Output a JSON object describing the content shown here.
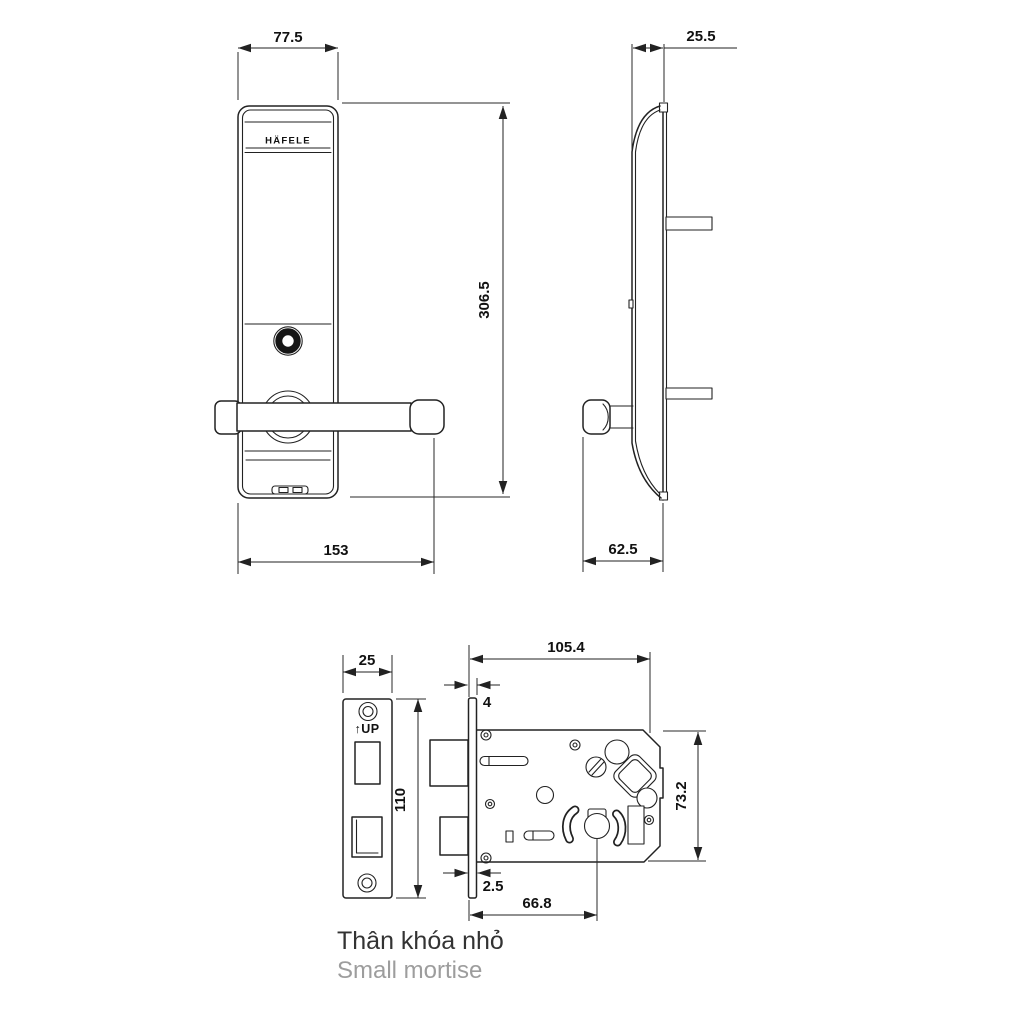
{
  "drawing": {
    "brand": "HÄFELE",
    "front_view": {
      "dim_width": "77.5",
      "dim_height": "306.5",
      "dim_total_width": "153"
    },
    "side_view": {
      "dim_depth": "25.5",
      "dim_handle_depth": "62.5"
    },
    "faceplate_view": {
      "up_label": "↑UP",
      "dim_width": "25",
      "dim_height": "110"
    },
    "mortise_body_view": {
      "dim_width": "105.4",
      "dim_height": "73.2",
      "dim_faceplate_thickness": "4",
      "dim_edge_offset": "2.5",
      "dim_backset": "66.8"
    },
    "caption": {
      "primary": "Thân khóa nhỏ",
      "secondary": "Small mortise"
    },
    "colors": {
      "line": "#222222",
      "text_primary": "#333333",
      "text_secondary": "#9d9d9d",
      "background": "#ffffff"
    }
  }
}
